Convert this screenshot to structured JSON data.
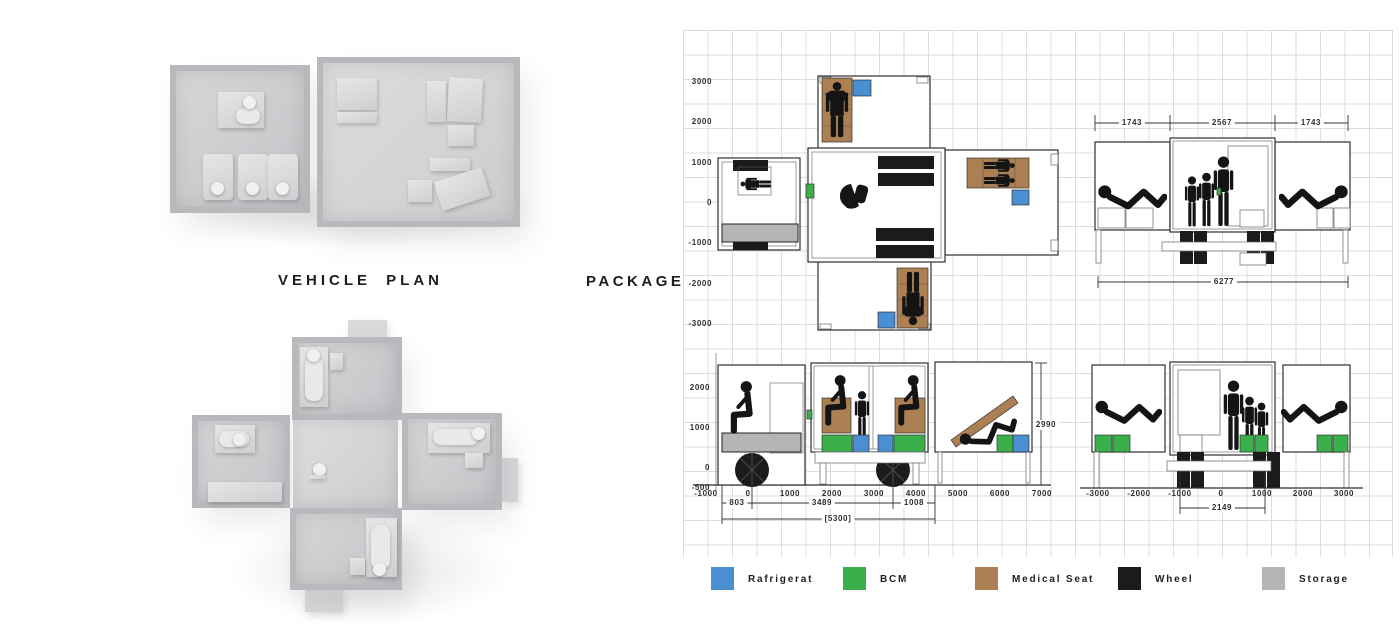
{
  "titles": {
    "vehicle_plan": "VEHICLE PLAN",
    "package": "PACKAGE"
  },
  "colors": {
    "refrigerator": "#4a8fd1",
    "bcm": "#3bb04a",
    "medical_seat": "#ac8052",
    "wheel": "#1b1b1b",
    "storage": "#b5b5b7"
  },
  "plan_view": {
    "y_axis": [
      "3000",
      "2000",
      "1000",
      "0",
      "-1000",
      "-2000",
      "-3000"
    ]
  },
  "front_elevation": {
    "dims": {
      "left": "1743",
      "center": "2567",
      "right": "1743",
      "total": "6277"
    }
  },
  "side_elevation": {
    "y_axis": [
      "2000",
      "1000",
      "0",
      "-500"
    ],
    "x_axis": [
      "-1000",
      "0",
      "1000",
      "2000",
      "3000",
      "4000",
      "5000",
      "6000",
      "7000"
    ],
    "dims": {
      "front": "803",
      "middle": "3489",
      "rear": "1008",
      "total": "[5300]",
      "height": "2990"
    }
  },
  "rear_elevation": {
    "x_axis": [
      "-3000",
      "-2000",
      "-1000",
      "0",
      "1000",
      "2000",
      "3000"
    ],
    "dims": {
      "width": "2149"
    }
  },
  "legend": [
    {
      "label": "Rafrigerat",
      "color_key": "refrigerator"
    },
    {
      "label": "BCM",
      "color_key": "bcm"
    },
    {
      "label": "Medical Seat",
      "color_key": "medical_seat"
    },
    {
      "label": "Wheel",
      "color_key": "wheel"
    },
    {
      "label": "Storage",
      "color_key": "storage"
    }
  ]
}
